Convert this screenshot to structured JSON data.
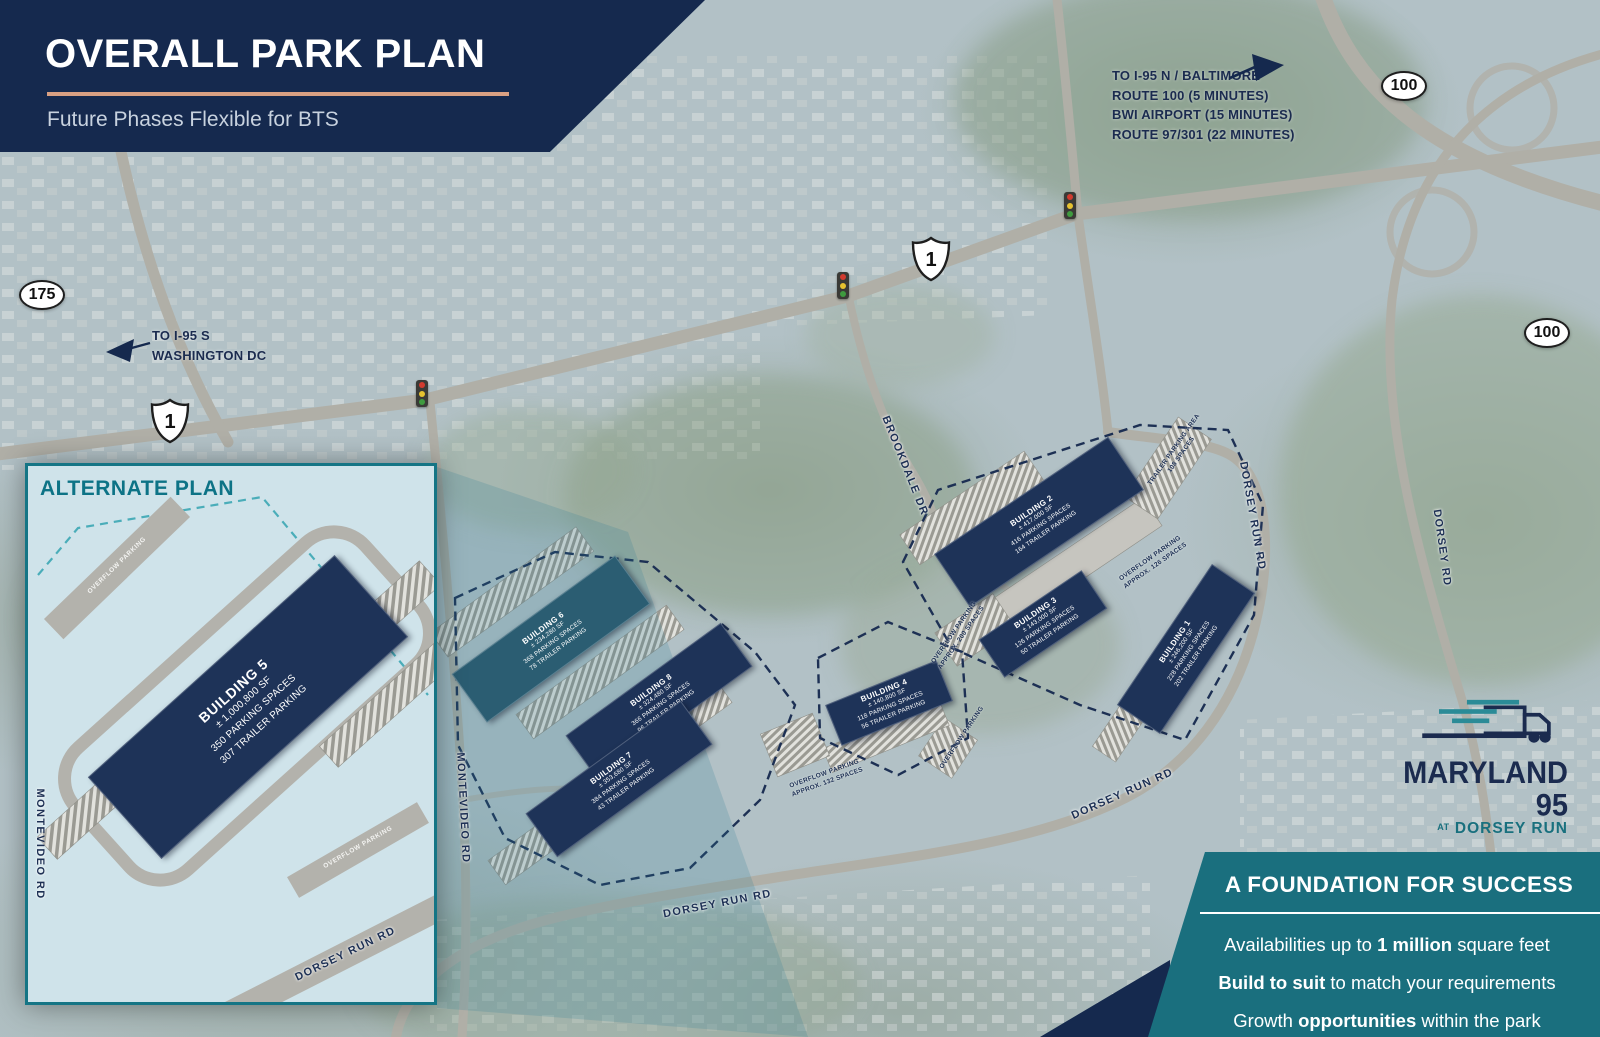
{
  "header": {
    "title": "OVERALL PARK PLAN",
    "subtitle": "Future Phases Flexible for BTS"
  },
  "directions": {
    "northeast": {
      "lines": [
        "TO I-95 N / BALTIMORE",
        "ROUTE 100 (5 MINUTES)",
        "BWI AIRPORT (15 MINUTES)",
        "ROUTE 97/301 (22 MINUTES)"
      ]
    },
    "southwest": {
      "lines": [
        "TO I-95 S",
        "WASHINGTON DC"
      ]
    }
  },
  "shields": {
    "route175": "175",
    "route100_top": "100",
    "route100_right": "100",
    "us1_top": "1",
    "us1_left": "1"
  },
  "road_labels": {
    "brookdale": "BROOKDALE DR",
    "dorsey_run_east": "DORSEY RUN RD",
    "dorsey_rd": "DORSEY RD",
    "dorsey_run_mid": "DORSEY RUN RD",
    "dorsey_run_bottom": "DORSEY RUN RD",
    "montevideo": "MONTEVIDEO RD"
  },
  "buildings": {
    "b1": {
      "name": "BUILDING 1",
      "size": "± 246,200 SF",
      "parking": "228 PARKING SPACES",
      "trailer": "202 TRAILER PARKING"
    },
    "b2": {
      "name": "BUILDING 2",
      "size": "± 417,000 SF",
      "parking": "416 PARKING SPACES",
      "trailer": "164 TRAILER PARKING"
    },
    "b3": {
      "name": "BUILDING 3",
      "size": "± 143,000 SF",
      "parking": "126 PARKING SPACES",
      "trailer": "50 TRAILER PARKING"
    },
    "b4": {
      "name": "BUILDING 4",
      "size": "± 140,800 SF",
      "parking": "118 PARKING SPACES",
      "trailer": "56 TRAILER PARKING"
    },
    "b6": {
      "name": "BUILDING 6",
      "size": "± 234,280 SF",
      "parking": "368 PARKING SPACES",
      "trailer": "78 TRAILER PARKING"
    },
    "b7": {
      "name": "BUILDING 7",
      "size": "± 353,680 SF",
      "parking": "384 PARKING SPACES",
      "trailer": "43 TRAILER PARKING"
    },
    "b8": {
      "name": "BUILDING 8",
      "size": "± 324,480 SF",
      "parking": "366 PARKING SPACES",
      "trailer": "96 TRAILER PARKING"
    }
  },
  "parking_labels": {
    "trailer_area": {
      "line1": "TRAILER PARKING AREA",
      "line2": "108 SPACES"
    },
    "overflow_e1": {
      "line1": "OVERFLOW PARKING",
      "line2": "APPROX. 126 SPACES"
    },
    "overflow_e2": {
      "line1": "OVERFLOW PARKING",
      "line2": "APPROX. 200 SPACES"
    },
    "overflow_c": {
      "line1": "OVERFLOW PARKING",
      "line2": "APPROX. 132 SPACES"
    },
    "overflow_small": {
      "line1": "OVERFLOW PARKING"
    }
  },
  "inset": {
    "title": "ALTERNATE PLAN",
    "building": {
      "name": "BUILDING 5",
      "size": "± 1,000,800 SF",
      "parking": "350 PARKING SPACES",
      "trailer": "307 TRAILER PARKING"
    },
    "overflow_top": "OVERFLOW PARKING",
    "overflow_bottom": "OVERFLOW PARKING",
    "roads": {
      "montevideo": "MONTEVIDEO RD",
      "dorsey_run": "DORSEY RUN RD"
    }
  },
  "logo": {
    "name": "MARYLAND 95",
    "at": "AT",
    "tagline": "DORSEY RUN"
  },
  "footer": {
    "title": "A FOUNDATION FOR SUCCESS",
    "lines": [
      {
        "pre": "Availabilities up to ",
        "bold": "1 million",
        "post": " square feet"
      },
      {
        "pre": "",
        "bold": "Build to suit",
        "post": " to match your requirements"
      },
      {
        "pre": "Growth ",
        "bold": "opportunities",
        "post": " within the park"
      }
    ]
  },
  "colors": {
    "navy": "#15294e",
    "teal": "#1a6f7e",
    "peach": "#d9a083",
    "building_navy": "#1e3358"
  }
}
